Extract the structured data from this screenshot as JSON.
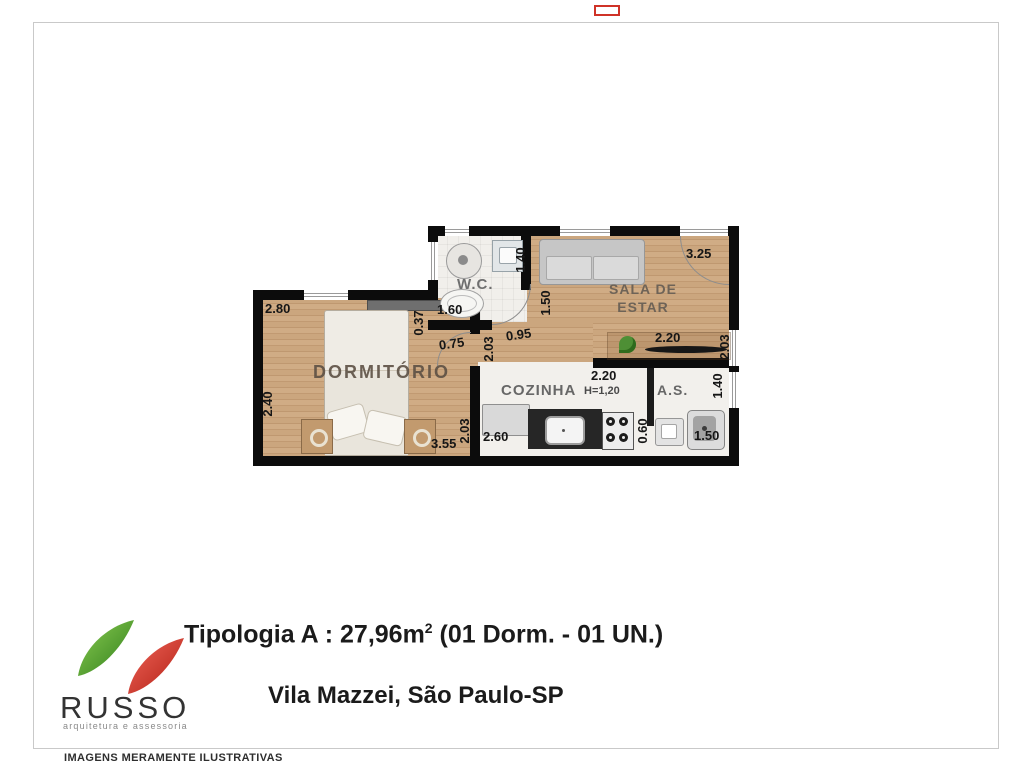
{
  "plan": {
    "rooms": {
      "dormitorio": "DORMITÓRIO",
      "wc": "W.C.",
      "sala_line1": "SALA DE",
      "sala_line2": "ESTAR",
      "cozinha": "COZINHA",
      "cozinha_height": "H=1,20",
      "as": "A.S."
    },
    "dims": {
      "dorm_top": "2.80",
      "dorm_left": "2.40",
      "dorm_bottom": "3.55",
      "dorm_right": "2.03",
      "pass_037": "0.37",
      "pass_075": "0.75",
      "pass_203": "2.03",
      "pass_095": "0.95",
      "wc_bottom": "1.60",
      "wc_right": "1.40",
      "sala_top": "3.25",
      "sala_left": "1.50",
      "sala_rack": "2.20",
      "sala_right": "2.03",
      "coz_top": "2.20",
      "coz_fridge": "2.60",
      "as_div": "0.60",
      "as_tank": "1.50",
      "as_right": "1.40"
    }
  },
  "footer": {
    "title_prefix": "Tipologia A : 27,96m",
    "title_sup": "2",
    "title_suffix": " (01 Dorm. - 01 UN.)",
    "location": "Vila Mazzei, São Paulo-SP",
    "logo_text": "RUSSO",
    "logo_subtext": "arquitetura e assessoria"
  },
  "disclaimer": "IMAGENS MERAMENTE ILUSTRATIVAS",
  "colors": {
    "wall": "#0c0c0c",
    "wood_floor": "#c7a179",
    "logo_green": "#57a437",
    "logo_red": "#d7362a",
    "frame_border": "#c9c9c9"
  }
}
